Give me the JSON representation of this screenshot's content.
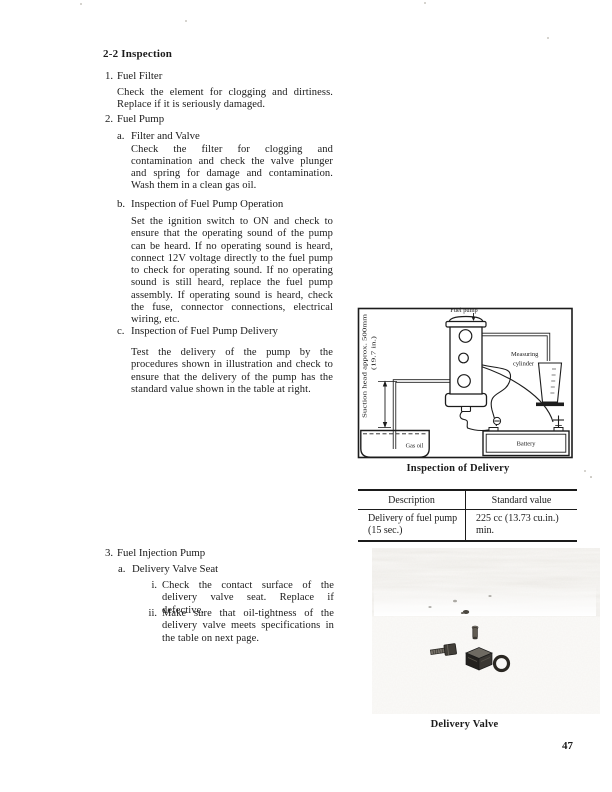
{
  "page_number": "47",
  "heading": "2-2 Inspection",
  "sections": {
    "s1": {
      "marker": "1.",
      "title": "Fuel Filter",
      "body": "Check the element for clogging and dirtiness. Replace if it is seriously damaged."
    },
    "s2": {
      "marker": "2.",
      "title": "Fuel Pump",
      "a": {
        "marker": "a.",
        "title": "Filter and Valve",
        "body": "Check the filter for clogging and contamination and check the valve plunger and spring for damage and contamination. Wash them in a clean gas oil."
      },
      "b": {
        "marker": "b.",
        "title": "Inspection of Fuel Pump Operation",
        "body": "Set the ignition switch to ON and check to ensure that the operating sound of the pump can be heard. If no operating sound is heard, connect 12V voltage directly to the fuel pump to check for operating sound. If no operating sound is still heard, replace the fuel pump assembly. If operating sound is heard, check the fuse, connector connections, electrical wiring, etc."
      },
      "c": {
        "marker": "c.",
        "title": "Inspection of Fuel Pump Delivery",
        "body": "Test the delivery of the pump by the procedures shown in illustration and check to ensure that the delivery of the pump has the standard value shown in the table at right."
      }
    },
    "s3": {
      "marker": "3.",
      "title": "Fuel Injection Pump",
      "a": {
        "marker": "a.",
        "title": "Delivery Valve Seat",
        "i": {
          "marker": "i.",
          "body": "Check the contact surface of the delivery valve seat. Replace if defective."
        },
        "ii": {
          "marker": "ii.",
          "body": "Make sure that oil-tightness of the delivery valve meets specifications in the table on next page."
        }
      }
    }
  },
  "figure": {
    "caption": "Inspection of Delivery",
    "labels": {
      "fuel_pump": "Fuel pump",
      "measuring_line1": "Measuring",
      "measuring_line2": "cylinder",
      "suction_line1": "Suction head approx. 500mm",
      "suction_line2": "(19.7 in.)",
      "gas_oil": "Gas oil",
      "battery": "Battery",
      "plus_symbol": "+"
    }
  },
  "table": {
    "headers": [
      "Description",
      "Standard value"
    ],
    "row": {
      "desc_line1": "Delivery of fuel pump",
      "desc_line2": "(15 sec.)",
      "value_line1": "225 cc (13.73 cu.in.)",
      "value_line2": "min."
    }
  },
  "photo": {
    "caption": "Delivery Valve"
  }
}
